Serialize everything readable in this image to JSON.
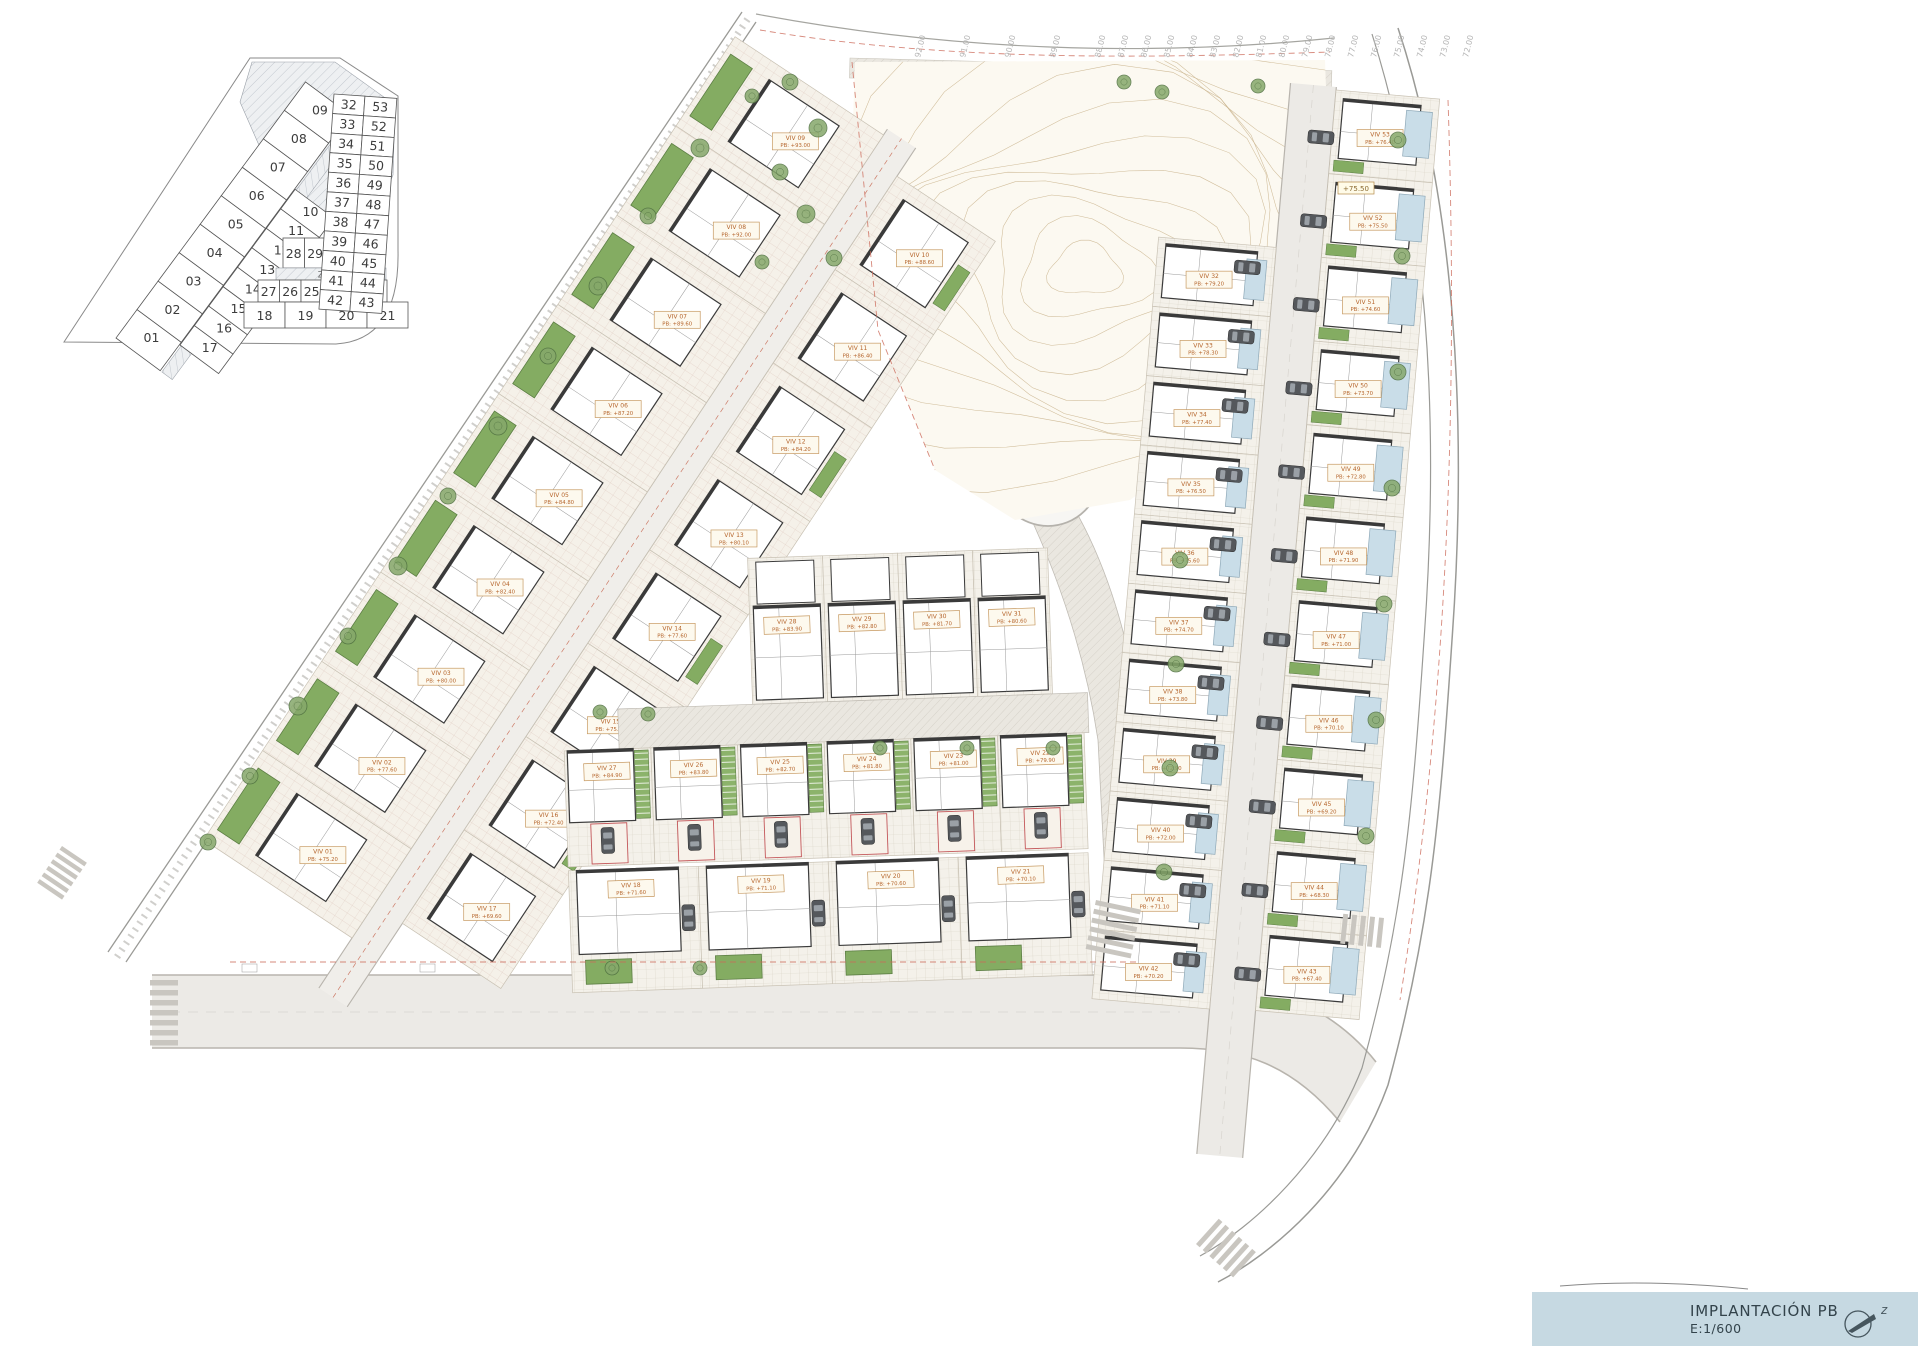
{
  "title_block": {
    "title": "IMPLANTACIÓN PB",
    "scale": "E:1/600"
  },
  "key_plan": {
    "zone_labels": [
      "ZC01",
      "ZC02"
    ],
    "outer_strip": [
      "01",
      "02",
      "03",
      "04",
      "05",
      "06",
      "07",
      "08",
      "09"
    ],
    "middle_strip": [
      "10",
      "11",
      "12",
      "13",
      "14",
      "15",
      "16",
      "17"
    ],
    "row_upper": [
      "28",
      "29",
      "30",
      "31"
    ],
    "row_lower": [
      "27",
      "26",
      "25",
      "24",
      "23",
      "22"
    ],
    "row_bottom": [
      "18",
      "19",
      "20",
      "21"
    ],
    "right_pairs": [
      [
        "32",
        "53"
      ],
      [
        "33",
        "52"
      ],
      [
        "34",
        "51"
      ],
      [
        "35",
        "50"
      ],
      [
        "36",
        "49"
      ],
      [
        "37",
        "48"
      ],
      [
        "38",
        "47"
      ],
      [
        "39",
        "46"
      ],
      [
        "40",
        "45"
      ],
      [
        "41",
        "44"
      ],
      [
        "42",
        "43"
      ]
    ]
  },
  "contour_labels": [
    "92.00",
    "91.00",
    "90.00",
    "89.00",
    "88.00",
    "87.00",
    "86.00",
    "85.00",
    "84.00",
    "83.00",
    "82.00",
    "81.00",
    "80.00",
    "79.00",
    "78.00",
    "77.00",
    "76.00",
    "75.00",
    "74.00",
    "73.00",
    "72.00"
  ],
  "spot_elevations": [
    {
      "label": "+75.50"
    }
  ],
  "villas": {
    "left_outer": [
      {
        "id": "VIV 01",
        "pb": "PB: +75.20"
      },
      {
        "id": "VIV 02",
        "pb": "PB: +77.60"
      },
      {
        "id": "VIV 03",
        "pb": "PB: +80.00"
      },
      {
        "id": "VIV 04",
        "pb": "PB: +82.40"
      },
      {
        "id": "VIV 05",
        "pb": "PB: +84.80"
      },
      {
        "id": "VIV 06",
        "pb": "PB: +87.20"
      },
      {
        "id": "VIV 07",
        "pb": "PB: +89.60"
      },
      {
        "id": "VIV 08",
        "pb": "PB: +92.00"
      },
      {
        "id": "VIV 09",
        "pb": "PB: +93.00"
      }
    ],
    "left_inner": [
      {
        "id": "VIV 10",
        "pb": "PB: +88.60"
      },
      {
        "id": "VIV 11",
        "pb": "PB: +86.40"
      },
      {
        "id": "VIV 12",
        "pb": "PB: +84.20"
      },
      {
        "id": "VIV 13",
        "pb": "PB: +80.10"
      },
      {
        "id": "VIV 14",
        "pb": "PB: +77.60"
      },
      {
        "id": "VIV 15",
        "pb": "PB: +75.10"
      },
      {
        "id": "VIV 16",
        "pb": "PB: +72.40"
      },
      {
        "id": "VIV 17",
        "pb": "PB: +69.60"
      }
    ],
    "central_top": [
      {
        "id": "VIV 28",
        "pb": "PB: +83.90"
      },
      {
        "id": "VIV 29",
        "pb": "PB: +82.80"
      },
      {
        "id": "VIV 30",
        "pb": "PB: +81.70"
      },
      {
        "id": "VIV 31",
        "pb": "PB: +80.60"
      }
    ],
    "central_mid": [
      {
        "id": "VIV 27",
        "pb": "PB: +84.90"
      },
      {
        "id": "VIV 26",
        "pb": "PB: +83.80"
      },
      {
        "id": "VIV 25",
        "pb": "PB: +82.70"
      },
      {
        "id": "VIV 24",
        "pb": "PB: +81.80"
      },
      {
        "id": "VIV 23",
        "pb": "PB: +81.00"
      },
      {
        "id": "VIV 22",
        "pb": "PB: +79.90"
      }
    ],
    "central_bottom": [
      {
        "id": "VIV 18",
        "pb": "PB: +71.60"
      },
      {
        "id": "VIV 19",
        "pb": "PB: +71.10"
      },
      {
        "id": "VIV 20",
        "pb": "PB: +70.60"
      },
      {
        "id": "VIV 21",
        "pb": "PB: +70.10"
      }
    ],
    "right_west": [
      {
        "id": "VIV 32",
        "pb": "PB: +79.20"
      },
      {
        "id": "VIV 33",
        "pb": "PB: +78.30"
      },
      {
        "id": "VIV 34",
        "pb": "PB: +77.40"
      },
      {
        "id": "VIV 35",
        "pb": "PB: +76.50"
      },
      {
        "id": "VIV 36",
        "pb": "PB: +75.60"
      },
      {
        "id": "VIV 37",
        "pb": "PB: +74.70"
      },
      {
        "id": "VIV 38",
        "pb": "PB: +73.80"
      },
      {
        "id": "VIV 39",
        "pb": "PB: +72.90"
      },
      {
        "id": "VIV 40",
        "pb": "PB: +72.00"
      },
      {
        "id": "VIV 41",
        "pb": "PB: +71.10"
      },
      {
        "id": "VIV 42",
        "pb": "PB: +70.20"
      }
    ],
    "right_east": [
      {
        "id": "VIV 53",
        "pb": "PB: +76.40"
      },
      {
        "id": "VIV 52",
        "pb": "PB: +75.50"
      },
      {
        "id": "VIV 51",
        "pb": "PB: +74.60"
      },
      {
        "id": "VIV 50",
        "pb": "PB: +73.70"
      },
      {
        "id": "VIV 49",
        "pb": "PB: +72.80"
      },
      {
        "id": "VIV 48",
        "pb": "PB: +71.90"
      },
      {
        "id": "VIV 47",
        "pb": "PB: +71.00"
      },
      {
        "id": "VIV 46",
        "pb": "PB: +70.10"
      },
      {
        "id": "VIV 45",
        "pb": "PB: +69.20"
      },
      {
        "id": "VIV 44",
        "pb": "PB: +68.30"
      },
      {
        "id": "VIV 43",
        "pb": "PB: +67.40"
      }
    ]
  },
  "colors": {
    "title_bg": "#c6d9e2",
    "pool_green": "#84ac62",
    "terrace_blue": "#c9dde8",
    "label_text": "#b5652c",
    "contour_line": "#c8b189",
    "boundary_red": "#cc6a5a"
  }
}
